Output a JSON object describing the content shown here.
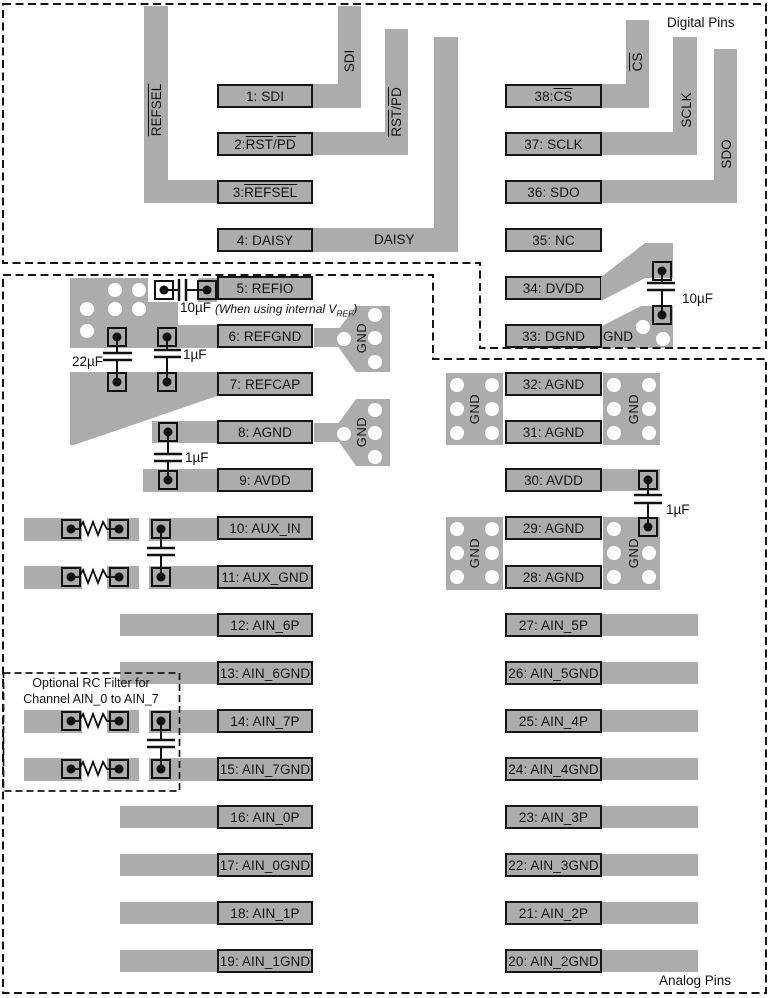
{
  "captions": {
    "digital": "Digital Pins",
    "analog": "Analog Pins"
  },
  "optional_filter_note": {
    "line1": "Optional RC Filter for",
    "line2": "Channel AIN_0 to AIN_7"
  },
  "ref_note": {
    "pre": "(When using internal V",
    "sub": "REF",
    "post": ")"
  },
  "capacitors": {
    "refio_10uf": "10µF",
    "refgnd_22uf": "22µF",
    "refcap_1uf": "1µF",
    "avdd9_1uf": "1µF",
    "dvdd_10uf": "10µF",
    "avdd30_1uf": "1µF"
  },
  "gnd_label": "GND",
  "colors": {
    "trace_gray": "#acacac",
    "outline_black": "#161616",
    "background": "#ffffff"
  },
  "trace_labels": {
    "sdi": "SDI",
    "sclk": "SCLK",
    "sdo": "SDO",
    "daisy": "DAISY",
    "refsel": [
      {
        "t": "REFSEL",
        "ov": true
      }
    ],
    "rstpd": [
      {
        "t": "RST",
        "ov": true
      },
      {
        "t": "/"
      },
      {
        "t": "PD",
        "ov": true
      }
    ],
    "cs": [
      {
        "t": "CS",
        "ov": true
      }
    ]
  },
  "pins": {
    "left": [
      {
        "id": "1-sdi",
        "parts": [
          {
            "t": "1: SDI"
          }
        ]
      },
      {
        "id": "2-rst-pd",
        "parts": [
          {
            "t": "2: "
          },
          {
            "t": "RST",
            "ov": true
          },
          {
            "t": "/"
          },
          {
            "t": "PD",
            "ov": true
          }
        ]
      },
      {
        "id": "3-refsel",
        "parts": [
          {
            "t": "3: "
          },
          {
            "t": "REFSEL",
            "ov": true
          }
        ]
      },
      {
        "id": "4-daisy",
        "parts": [
          {
            "t": "4: DAISY"
          }
        ]
      },
      {
        "id": "5-refio",
        "parts": [
          {
            "t": "5: REFIO"
          }
        ]
      },
      {
        "id": "6-refgnd",
        "parts": [
          {
            "t": "6: REFGND"
          }
        ]
      },
      {
        "id": "7-refcap",
        "parts": [
          {
            "t": "7: REFCAP"
          }
        ]
      },
      {
        "id": "8-agnd",
        "parts": [
          {
            "t": "8: AGND"
          }
        ]
      },
      {
        "id": "9-avdd",
        "parts": [
          {
            "t": "9: AVDD"
          }
        ]
      },
      {
        "id": "10-aux-in",
        "parts": [
          {
            "t": "10: AUX_IN"
          }
        ]
      },
      {
        "id": "11-aux-gnd",
        "parts": [
          {
            "t": "11: AUX_GND"
          }
        ]
      },
      {
        "id": "12-ain-6p",
        "parts": [
          {
            "t": "12: AIN_6P"
          }
        ],
        "trace": "L"
      },
      {
        "id": "13-ain-6gnd",
        "parts": [
          {
            "t": "13: AIN_6GND"
          }
        ],
        "trace": "L"
      },
      {
        "id": "14-ain-7p",
        "parts": [
          {
            "t": "14: AIN_7P"
          }
        ]
      },
      {
        "id": "15-ain-7gnd",
        "parts": [
          {
            "t": "15: AIN_7GND"
          }
        ]
      },
      {
        "id": "16-ain-0p",
        "parts": [
          {
            "t": "16: AIN_0P"
          }
        ],
        "trace": "L"
      },
      {
        "id": "17-ain-0gnd",
        "parts": [
          {
            "t": "17: AIN_0GND"
          }
        ],
        "trace": "L"
      },
      {
        "id": "18-ain-1p",
        "parts": [
          {
            "t": "18: AIN_1P"
          }
        ],
        "trace": "L"
      },
      {
        "id": "19-ain-1gnd",
        "parts": [
          {
            "t": "19: AIN_1GND"
          }
        ],
        "trace": "L"
      }
    ],
    "right": [
      {
        "id": "38-cs",
        "parts": [
          {
            "t": "38: "
          },
          {
            "t": "CS",
            "ov": true
          }
        ]
      },
      {
        "id": "37-sclk",
        "parts": [
          {
            "t": "37: SCLK"
          }
        ]
      },
      {
        "id": "36-sdo",
        "parts": [
          {
            "t": "36: SDO"
          }
        ]
      },
      {
        "id": "35-nc",
        "parts": [
          {
            "t": "35: NC"
          }
        ]
      },
      {
        "id": "34-dvdd",
        "parts": [
          {
            "t": "34: DVDD"
          }
        ]
      },
      {
        "id": "33-dgnd",
        "parts": [
          {
            "t": "33: DGND"
          }
        ]
      },
      {
        "id": "32-agnd",
        "parts": [
          {
            "t": "32: AGND"
          }
        ]
      },
      {
        "id": "31-agnd",
        "parts": [
          {
            "t": "31: AGND"
          }
        ]
      },
      {
        "id": "30-avdd",
        "parts": [
          {
            "t": "30: AVDD"
          }
        ],
        "trace": "S"
      },
      {
        "id": "29-agnd",
        "parts": [
          {
            "t": "29: AGND"
          }
        ]
      },
      {
        "id": "28-agnd",
        "parts": [
          {
            "t": "28: AGND"
          }
        ]
      },
      {
        "id": "27-ain-5p",
        "parts": [
          {
            "t": "27: AIN_5P"
          }
        ],
        "trace": "R"
      },
      {
        "id": "26-ain-5gnd",
        "parts": [
          {
            "t": "26: AIN_5GND"
          }
        ],
        "trace": "R"
      },
      {
        "id": "25-ain-4p",
        "parts": [
          {
            "t": "25: AIN_4P"
          }
        ],
        "trace": "R"
      },
      {
        "id": "24-ain-4gnd",
        "parts": [
          {
            "t": "24: AIN_4GND"
          }
        ],
        "trace": "R"
      },
      {
        "id": "23-ain-3p",
        "parts": [
          {
            "t": "23: AIN_3P"
          }
        ],
        "trace": "R"
      },
      {
        "id": "22-ain-3gnd",
        "parts": [
          {
            "t": "22: AIN_3GND"
          }
        ],
        "trace": "R"
      },
      {
        "id": "21-ain-2p",
        "parts": [
          {
            "t": "21: AIN_2P"
          }
        ],
        "trace": "R"
      },
      {
        "id": "20-ain-2gnd",
        "parts": [
          {
            "t": "20: AIN_2GND"
          }
        ],
        "trace": "R"
      }
    ]
  }
}
